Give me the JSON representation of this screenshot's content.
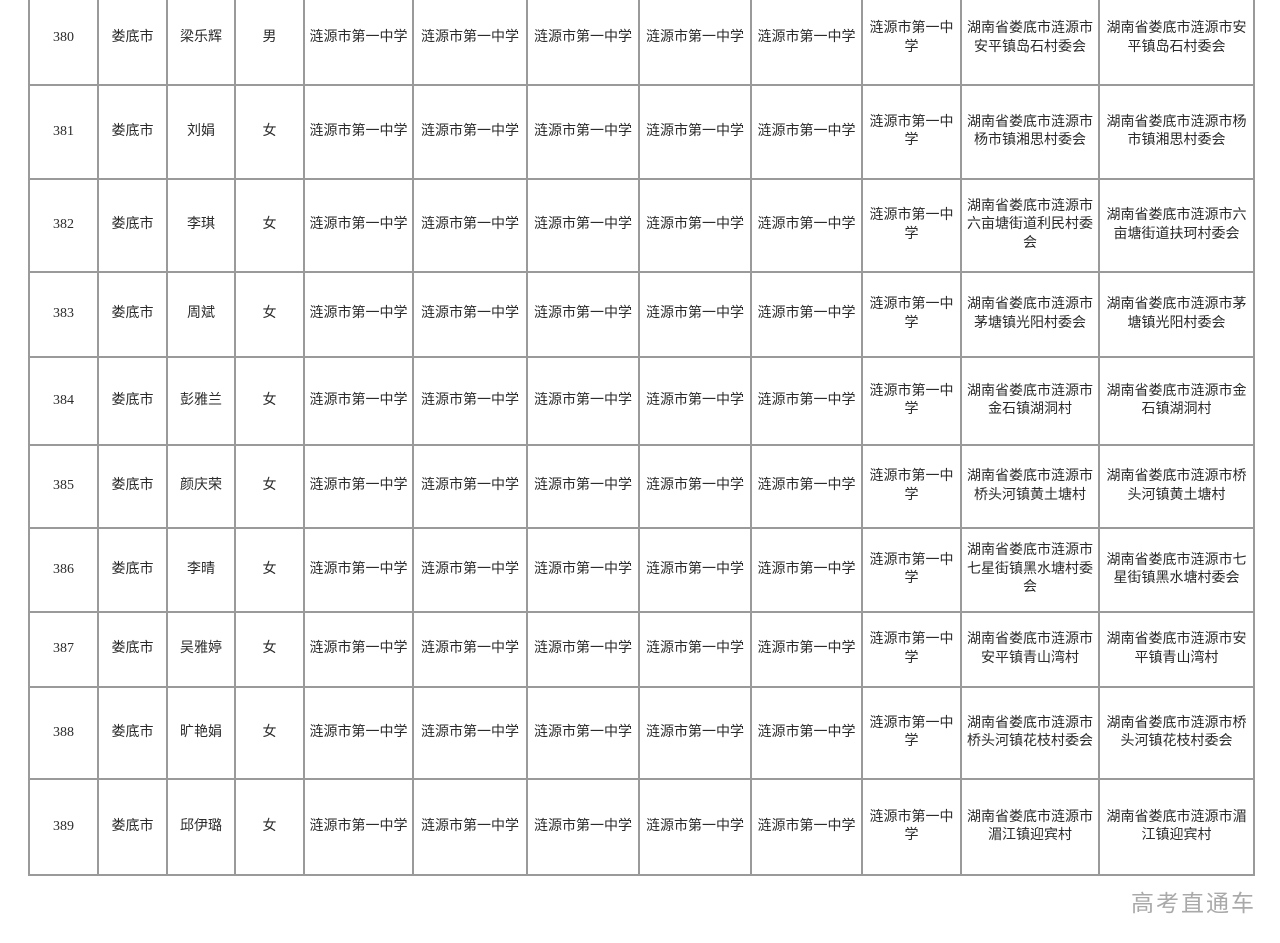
{
  "colors": {
    "border": "#9a9a9a",
    "text": "#2b2b2b",
    "watermark": "#a9a9a9",
    "background": "#ffffff"
  },
  "watermark": {
    "label": "高考直通车"
  },
  "table": {
    "rows": [
      {
        "no": "380",
        "city": "娄底市",
        "name": "梁乐辉",
        "gender": "男",
        "schools": [
          "涟源市第一中学",
          "涟源市第一中学",
          "涟源市第一中学",
          "涟源市第一中学",
          "涟源市第一中学",
          "涟源市第一中学"
        ],
        "address1": "湖南省娄底市涟源市安平镇岛石村委会",
        "address2": "湖南省娄底市涟源市安平镇岛石村委会"
      },
      {
        "no": "381",
        "city": "娄底市",
        "name": "刘娟",
        "gender": "女",
        "schools": [
          "涟源市第一中学",
          "涟源市第一中学",
          "涟源市第一中学",
          "涟源市第一中学",
          "涟源市第一中学",
          "涟源市第一中学"
        ],
        "address1": "湖南省娄底市涟源市杨市镇湘思村委会",
        "address2": "湖南省娄底市涟源市杨市镇湘思村委会"
      },
      {
        "no": "382",
        "city": "娄底市",
        "name": "李琪",
        "gender": "女",
        "schools": [
          "涟源市第一中学",
          "涟源市第一中学",
          "涟源市第一中学",
          "涟源市第一中学",
          "涟源市第一中学",
          "涟源市第一中学"
        ],
        "address1": "湖南省娄底市涟源市六亩塘街道利民村委会",
        "address2": "湖南省娄底市涟源市六亩塘街道扶珂村委会"
      },
      {
        "no": "383",
        "city": "娄底市",
        "name": "周斌",
        "gender": "女",
        "schools": [
          "涟源市第一中学",
          "涟源市第一中学",
          "涟源市第一中学",
          "涟源市第一中学",
          "涟源市第一中学",
          "涟源市第一中学"
        ],
        "address1": "湖南省娄底市涟源市茅塘镇光阳村委会",
        "address2": "湖南省娄底市涟源市茅塘镇光阳村委会"
      },
      {
        "no": "384",
        "city": "娄底市",
        "name": "彭雅兰",
        "gender": "女",
        "schools": [
          "涟源市第一中学",
          "涟源市第一中学",
          "涟源市第一中学",
          "涟源市第一中学",
          "涟源市第一中学",
          "涟源市第一中学"
        ],
        "address1": "湖南省娄底市涟源市金石镇湖洞村",
        "address2": "湖南省娄底市涟源市金石镇湖洞村"
      },
      {
        "no": "385",
        "city": "娄底市",
        "name": "颜庆荣",
        "gender": "女",
        "schools": [
          "涟源市第一中学",
          "涟源市第一中学",
          "涟源市第一中学",
          "涟源市第一中学",
          "涟源市第一中学",
          "涟源市第一中学"
        ],
        "address1": "湖南省娄底市涟源市桥头河镇黄土塘村",
        "address2": "湖南省娄底市涟源市桥头河镇黄土塘村"
      },
      {
        "no": "386",
        "city": "娄底市",
        "name": "李晴",
        "gender": "女",
        "schools": [
          "涟源市第一中学",
          "涟源市第一中学",
          "涟源市第一中学",
          "涟源市第一中学",
          "涟源市第一中学",
          "涟源市第一中学"
        ],
        "address1": "湖南省娄底市涟源市七星街镇黑水塘村委会",
        "address2": "湖南省娄底市涟源市七星街镇黑水塘村委会"
      },
      {
        "no": "387",
        "city": "娄底市",
        "name": "吴雅婷",
        "gender": "女",
        "schools": [
          "涟源市第一中学",
          "涟源市第一中学",
          "涟源市第一中学",
          "涟源市第一中学",
          "涟源市第一中学",
          "涟源市第一中学"
        ],
        "address1": "湖南省娄底市涟源市安平镇青山湾村",
        "address2": "湖南省娄底市涟源市安平镇青山湾村"
      },
      {
        "no": "388",
        "city": "娄底市",
        "name": "旷艳娟",
        "gender": "女",
        "schools": [
          "涟源市第一中学",
          "涟源市第一中学",
          "涟源市第一中学",
          "涟源市第一中学",
          "涟源市第一中学",
          "涟源市第一中学"
        ],
        "address1": "湖南省娄底市涟源市桥头河镇花枝村委会",
        "address2": "湖南省娄底市涟源市桥头河镇花枝村委会"
      },
      {
        "no": "389",
        "city": "娄底市",
        "name": "邱伊璐",
        "gender": "女",
        "schools": [
          "涟源市第一中学",
          "涟源市第一中学",
          "涟源市第一中学",
          "涟源市第一中学",
          "涟源市第一中学",
          "涟源市第一中学"
        ],
        "address1": "湖南省娄底市涟源市湄江镇迎宾村",
        "address2": "湖南省娄底市涟源市湄江镇迎宾村"
      }
    ]
  }
}
